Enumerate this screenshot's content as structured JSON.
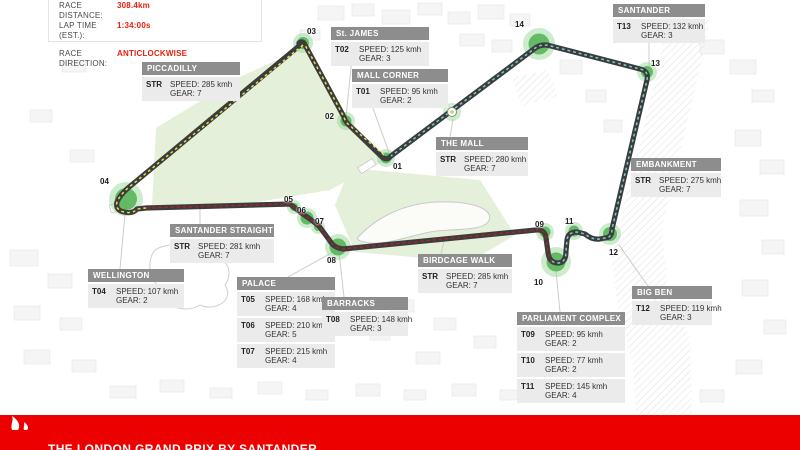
{
  "race_info": {
    "distance_label": "RACE DISTANCE:",
    "distance_value": "308.4km",
    "lap_time_label": "LAP TIME (EST.):",
    "lap_time_value": "1:34:00s",
    "direction_label": "RACE DIRECTION:",
    "direction_value": "ANTICLOCKWISE"
  },
  "labels": {
    "speed": "SPEED:",
    "gear": "GEAR:"
  },
  "callouts": [
    {
      "id": "piccadilly",
      "title": "PICCADILLY",
      "rows": [
        {
          "code": "STR",
          "speed": "285 kmh",
          "gear": "7"
        }
      ]
    },
    {
      "id": "st-james",
      "title": "St. JAMES",
      "rows": [
        {
          "code": "T02",
          "speed": "125 kmh",
          "gear": "3"
        }
      ]
    },
    {
      "id": "mall-corner",
      "title": "MALL CORNER",
      "rows": [
        {
          "code": "T01",
          "speed": "95 kmh",
          "gear": "2"
        }
      ]
    },
    {
      "id": "santander",
      "title": "SANTANDER",
      "rows": [
        {
          "code": "T13",
          "speed": "132 kmh",
          "gear": "3"
        }
      ]
    },
    {
      "id": "the-mall",
      "title": "THE MALL",
      "rows": [
        {
          "code": "STR",
          "speed": "280 kmh",
          "gear": "7"
        }
      ]
    },
    {
      "id": "embankment",
      "title": "EMBANKMENT",
      "rows": [
        {
          "code": "STR",
          "speed": "275 kmh",
          "gear": "7"
        }
      ]
    },
    {
      "id": "santander-straight",
      "title": "SANTANDER STRAIGHT",
      "rows": [
        {
          "code": "STR",
          "speed": "281 kmh",
          "gear": "7"
        }
      ]
    },
    {
      "id": "wellington",
      "title": "WELLINGTON",
      "rows": [
        {
          "code": "T04",
          "speed": "107 kmh",
          "gear": "2"
        }
      ]
    },
    {
      "id": "palace",
      "title": "PALACE",
      "rows": [
        {
          "code": "T05",
          "speed": "168 kmh",
          "gear": "4"
        },
        {
          "code": "T06",
          "speed": "210 kmh",
          "gear": "5"
        },
        {
          "code": "T07",
          "speed": "215 kmh",
          "gear": "4"
        }
      ]
    },
    {
      "id": "barracks",
      "title": "BARRACKS",
      "rows": [
        {
          "code": "T08",
          "speed": "148 kmh",
          "gear": "3"
        }
      ]
    },
    {
      "id": "birdcage-walk",
      "title": "BIRDCAGE WALK",
      "rows": [
        {
          "code": "STR",
          "speed": "285 kmh",
          "gear": "7"
        }
      ]
    },
    {
      "id": "parliament-complex",
      "title": "PARLIAMENT COMPLEX",
      "rows": [
        {
          "code": "T09",
          "speed": "95 kmh",
          "gear": "2"
        },
        {
          "code": "T10",
          "speed": "77 kmh",
          "gear": "2"
        },
        {
          "code": "T11",
          "speed": "145 kmh",
          "gear": "4"
        }
      ]
    },
    {
      "id": "big-ben",
      "title": "BIG BEN",
      "rows": [
        {
          "code": "T12",
          "speed": "119 kmh",
          "gear": "3"
        }
      ]
    }
  ],
  "corners": [
    {
      "num": "01"
    },
    {
      "num": "02"
    },
    {
      "num": "03"
    },
    {
      "num": "04"
    },
    {
      "num": "05"
    },
    {
      "num": "06"
    },
    {
      "num": "07"
    },
    {
      "num": "08"
    },
    {
      "num": "09"
    },
    {
      "num": "10"
    },
    {
      "num": "11"
    },
    {
      "num": "12"
    },
    {
      "num": "13"
    },
    {
      "num": "14"
    }
  ],
  "footer": {
    "title": "THE LONDON GRAND PRIX BY SANTANDER"
  },
  "colors": {
    "red": "#ec0000",
    "redtext": "#e8200f",
    "track": "#3c3c3c",
    "yellow": "#e6e04a",
    "teal": "#74d0d0",
    "maroon": "#a42626",
    "green": "#52b152",
    "greenhalo": "#90d290",
    "park": "#e4f0da",
    "head": "#8d8d8d",
    "body": "#ebebeb"
  }
}
